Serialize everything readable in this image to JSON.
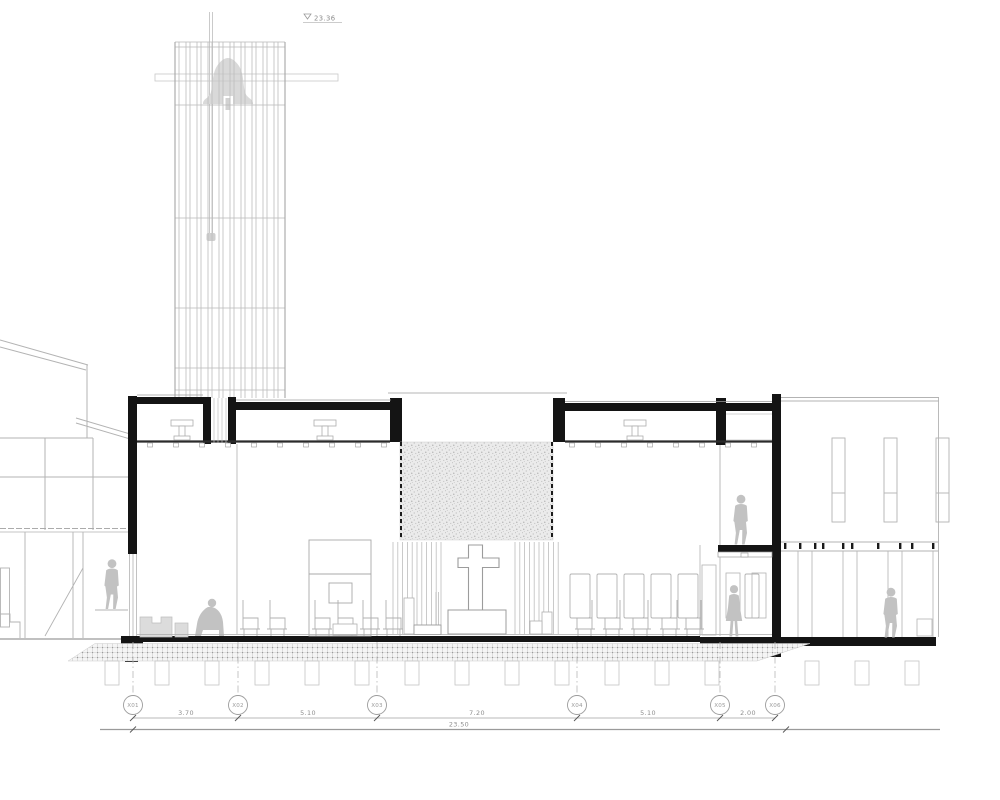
{
  "drawing": {
    "type": "architectural cross-section of a church with bell tower",
    "level_marker": {
      "symbol": "level-datum-triangle",
      "value": "23.36"
    },
    "grid": {
      "bubbles": [
        {
          "label": "X01"
        },
        {
          "label": "X02"
        },
        {
          "label": "X03"
        },
        {
          "label": "X04"
        },
        {
          "label": "X05"
        },
        {
          "label": "X06"
        }
      ],
      "segment_dims": [
        "3.70",
        "5.10",
        "7.20",
        "5.10",
        "2.00"
      ],
      "overall_dim": "23.50"
    },
    "colors": {
      "cut_poche": "#141414",
      "elevation_line": "#b3b3b3",
      "figure_fill": "#c2c2c2",
      "bell_fill": "#d9d9d9",
      "texture_panel_base": "#ebebeb",
      "dim_text": "#8c8c8c"
    },
    "icons": [
      "bell-icon",
      "cross-symbol",
      "level-triangle-icon",
      "person-walking-figure",
      "person-seated-figure"
    ]
  }
}
